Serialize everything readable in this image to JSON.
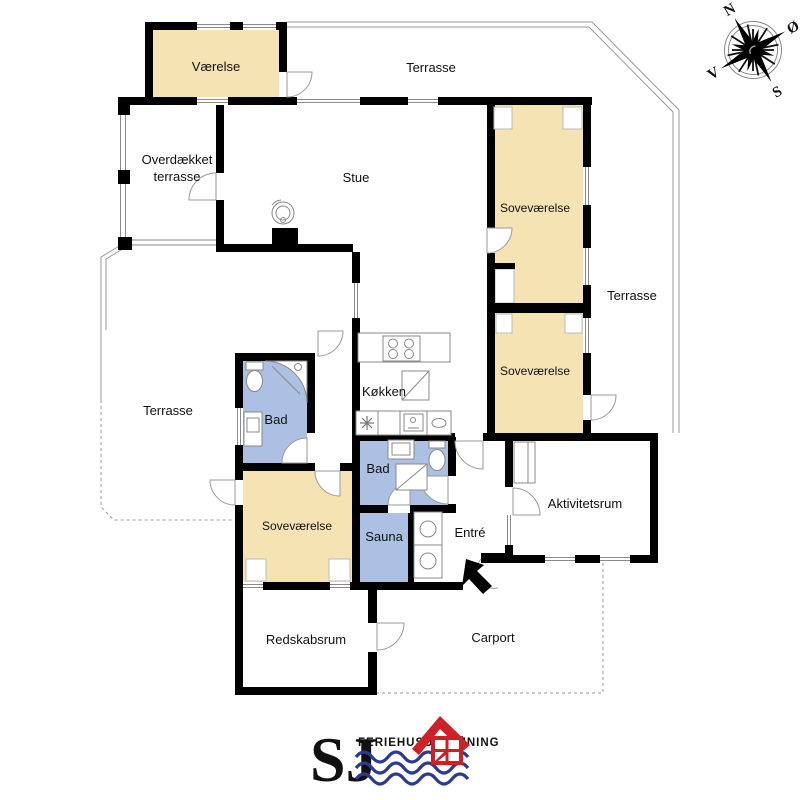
{
  "colors": {
    "bedroom": "#F6E3B3",
    "bath": "#ABC0E2",
    "wall": "#000000",
    "outline": "#9a9a9a",
    "logo_blue": "#2B3A94",
    "logo_red": "#CE2127"
  },
  "rooms": {
    "vaerelse": {
      "label": "Værelse"
    },
    "terrasse_top": {
      "label": "Terrasse"
    },
    "overdaekket_terrasse": {
      "line1": "Overdækket",
      "line2": "terrasse"
    },
    "stue": {
      "label": "Stue"
    },
    "sovevaerelse_1": {
      "label": "Soveværelse"
    },
    "terrasse_right": {
      "label": "Terrasse"
    },
    "sovevaerelse_2": {
      "label": "Soveværelse"
    },
    "koekken": {
      "label": "Køkken"
    },
    "terrasse_left": {
      "label": "Terrasse"
    },
    "bad_1": {
      "label": "Bad"
    },
    "bad_2": {
      "label": "Bad"
    },
    "sovevaerelse_3": {
      "label": "Soveværelse"
    },
    "sauna": {
      "label": "Sauna"
    },
    "entre": {
      "label": "Entré"
    },
    "aktivitetsrum": {
      "label": "Aktivitetsrum"
    },
    "redskabsrum": {
      "label": "Redskabsrum"
    },
    "carport": {
      "label": "Carport"
    }
  },
  "compass": {
    "north": "N",
    "east": "Ø",
    "south": "S",
    "west": "V"
  },
  "logo": {
    "initials": "SJ",
    "name": "FERIEHUSUDLEJNING"
  }
}
